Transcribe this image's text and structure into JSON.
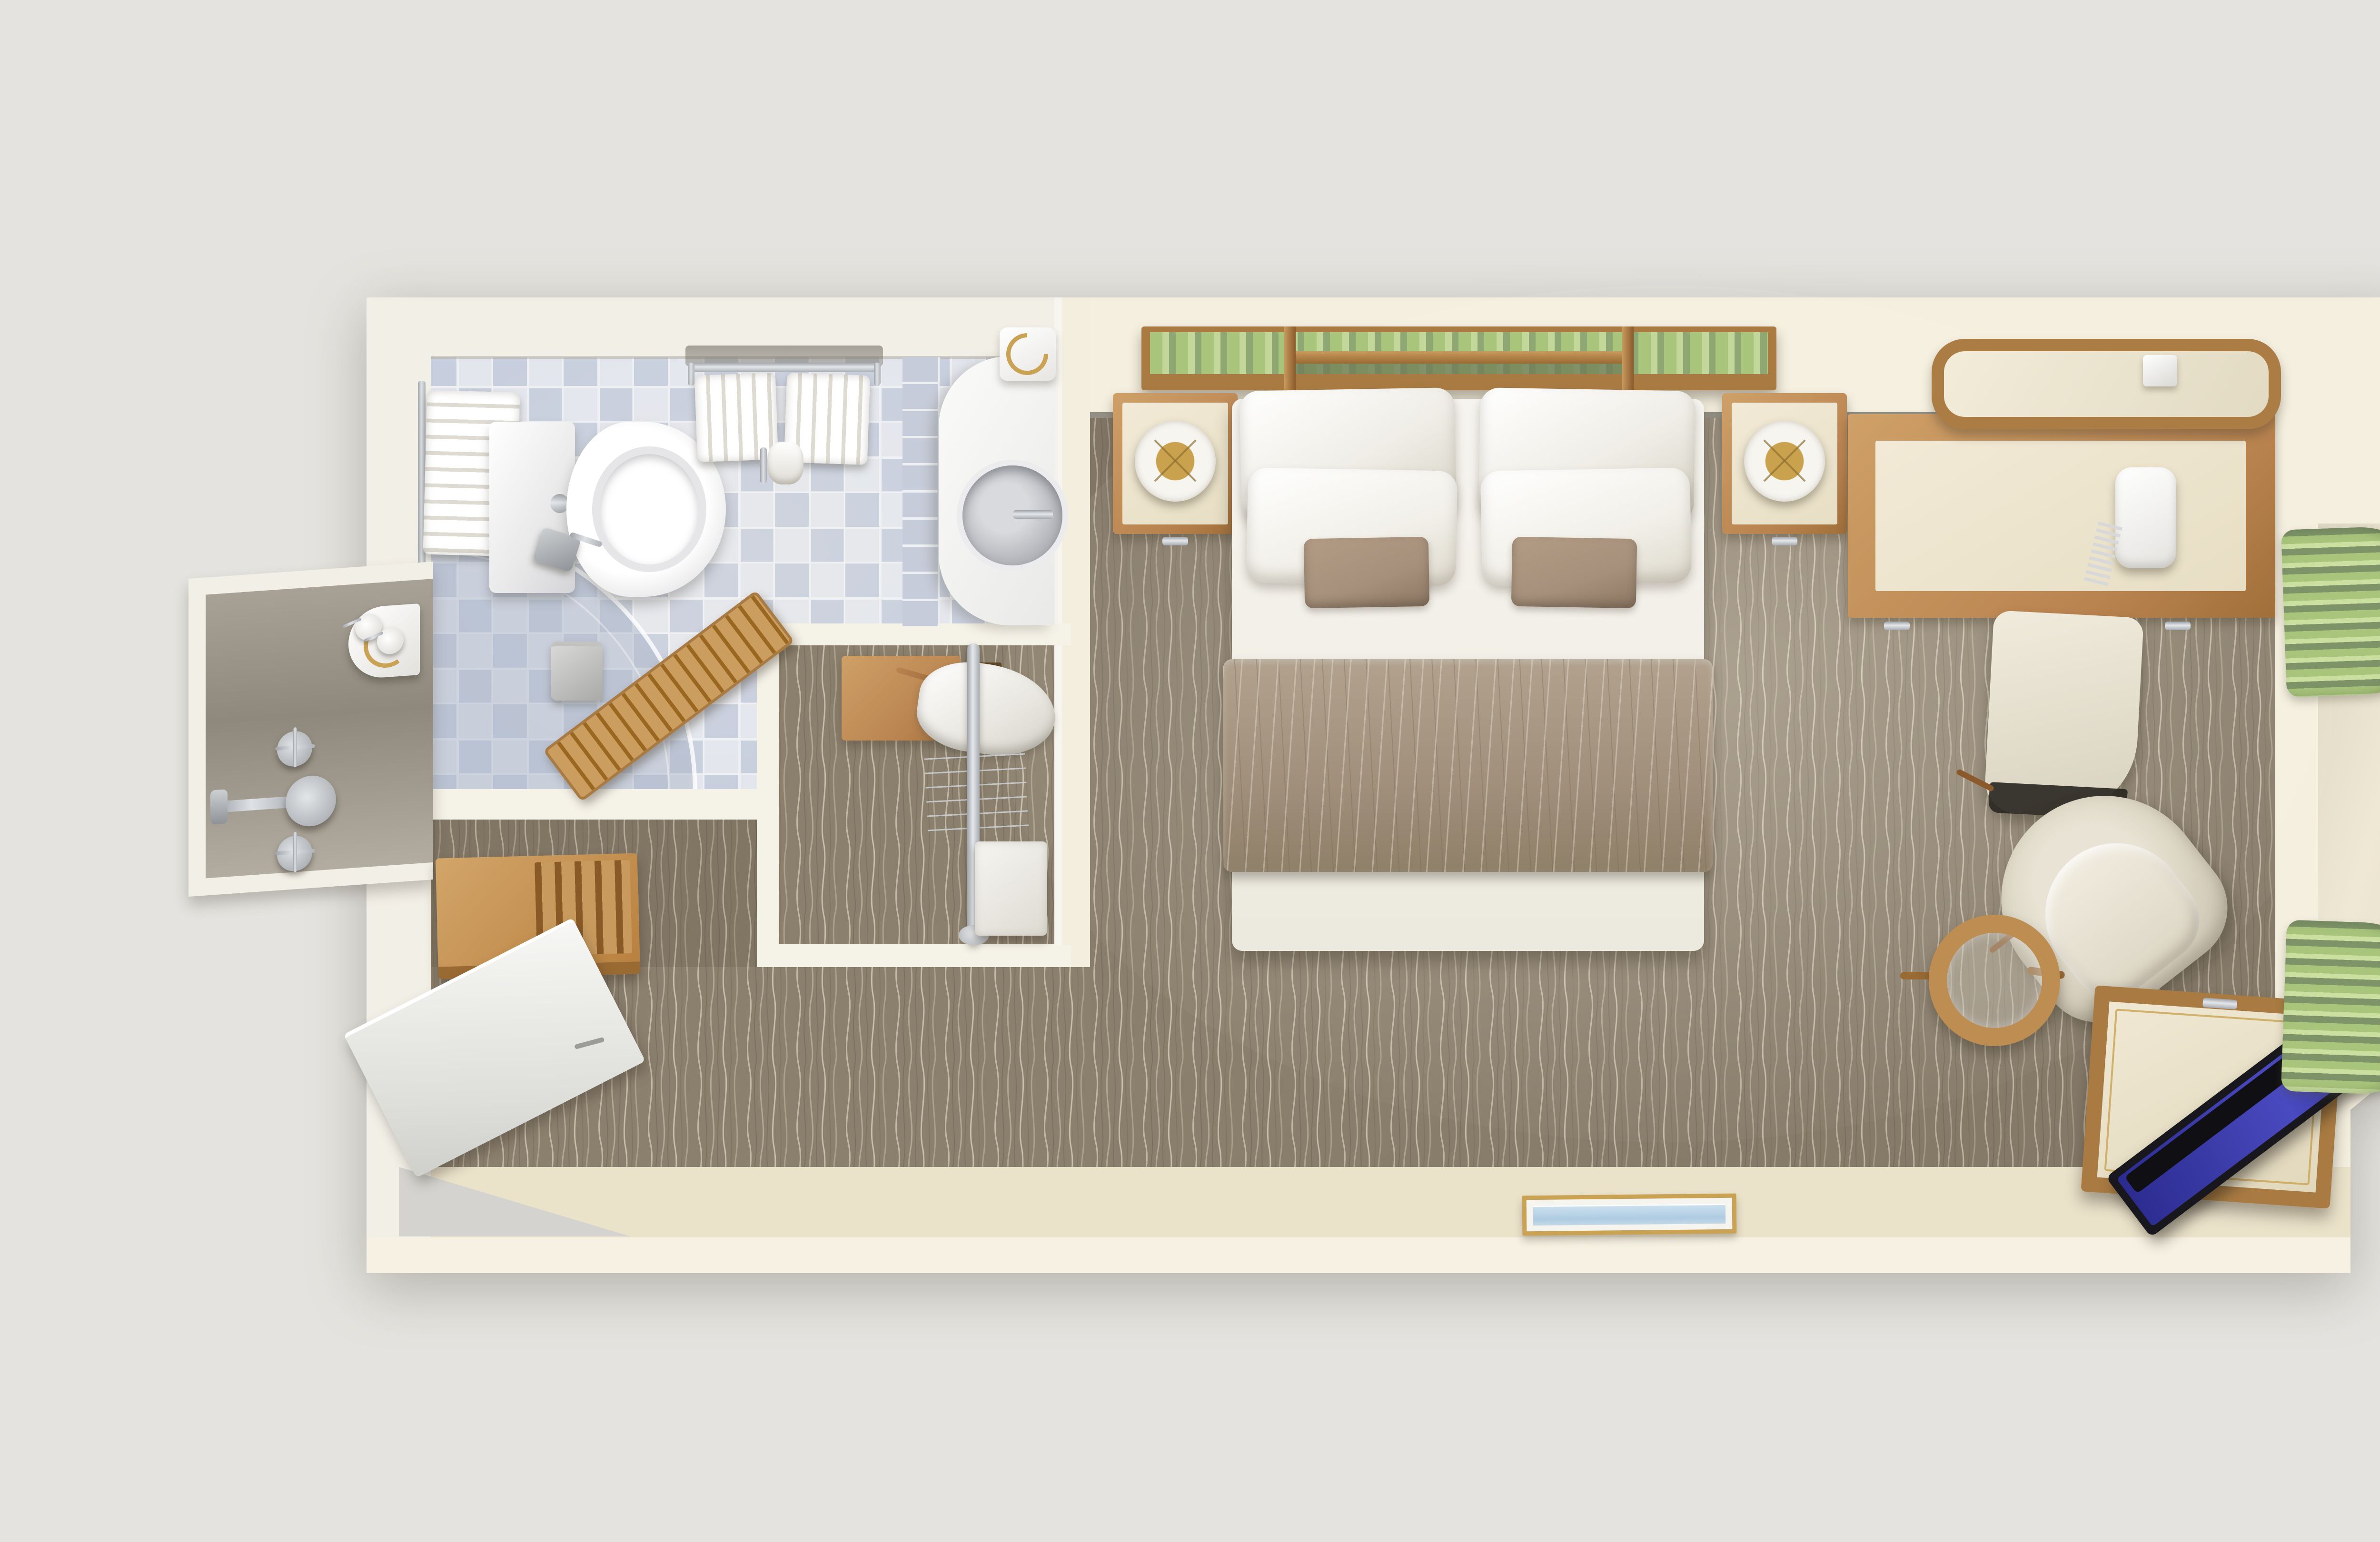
{
  "image": {
    "kind": "3d-rendered-floor-plan",
    "view": "top-down dollhouse cutaway",
    "subject": "hotel / cruise-ship stateroom with ensuite bathroom",
    "visible_text": "none"
  },
  "palette": {
    "bg": "#e4e3df",
    "shell": "#f4efdf",
    "shellWhite": "#f2efe7",
    "wallBand": "#f6f1e2",
    "floorCream": "#ebe2ca",
    "carpet": "#8b7f6d",
    "carpetLine": "#c9bfaa",
    "tileLight": "#e3e6ed",
    "tileBlue": "#c7cedd",
    "wood": "#b9834f",
    "woodLight": "#cfa068",
    "woodDark": "#7c5026",
    "frame": "#a97b42",
    "white": "#f7f6f2",
    "linen": "#efede6",
    "taupe": "#a6907b",
    "runner": "#a79582",
    "green1": "#a9c57c",
    "green2": "#7e9468",
    "green3": "#cadfa0",
    "glass": "#e9eef3",
    "alcove": "#a39a8d",
    "tvScreen": "#3434a0",
    "tvBezel": "#17171d",
    "gold": "#c9a253",
    "chrome": "#c3c6ca"
  },
  "rooms": [
    {
      "name": "bathroom",
      "floor": "blue-and-white checkerboard tile",
      "items": [
        "toilet with tank",
        "wall towel bar with towel",
        "towel shelf with 2 hanging towels",
        "toilet-paper holder",
        "waste bin",
        "vanity counter with round basin and faucet",
        "gold-trim wall accessory",
        "wooden duckboard bath mat",
        "curved glass shower enclosure"
      ]
    },
    {
      "name": "shower-alcove",
      "items": [
        "corner toiletry shelf with 2 dispenser bottles",
        "two cross-handle valves",
        "central mixer with spout",
        "shower head"
      ]
    },
    {
      "name": "wardrobe-closet",
      "items": [
        "wooden safe box",
        "hanging white bathrobe on wooden hanger",
        "chrome closet rod",
        "wire shoe rack",
        "white storage box"
      ]
    },
    {
      "name": "entry",
      "items": [
        "open white entry door",
        "wooden luggage rack with slats"
      ]
    },
    {
      "name": "bedroom",
      "floor": "taupe carpet with wavy line pattern",
      "items": [
        "double bed",
        "4 white pillows",
        "2 taupe accent pillows",
        "taupe bed runner",
        "green striped headboard with wood frame",
        "2 nightstands",
        "2 drum lamps with gold spokes",
        "desk with cream top",
        "white corded telephone",
        "upholstered desk stool",
        "wood-framed wall mirror",
        "wall control panel",
        "cream tub armchair",
        "round glass side table with wood rim",
        "TV cabinet",
        "flat-screen TV leaning on cabinet",
        "gold-framed seascape artwork"
      ]
    },
    {
      "name": "window-bay",
      "items": [
        "green folded curtain stack top",
        "green folded curtain stack bottom",
        "curtain rod",
        "large picture window with rounded corners and 2 mullions",
        "glass panel"
      ]
    }
  ],
  "counts": {
    "white_pillows": 4,
    "accent_pillows": 2,
    "hanging_towels": 2,
    "lamps": 2,
    "nightstands": 2
  }
}
